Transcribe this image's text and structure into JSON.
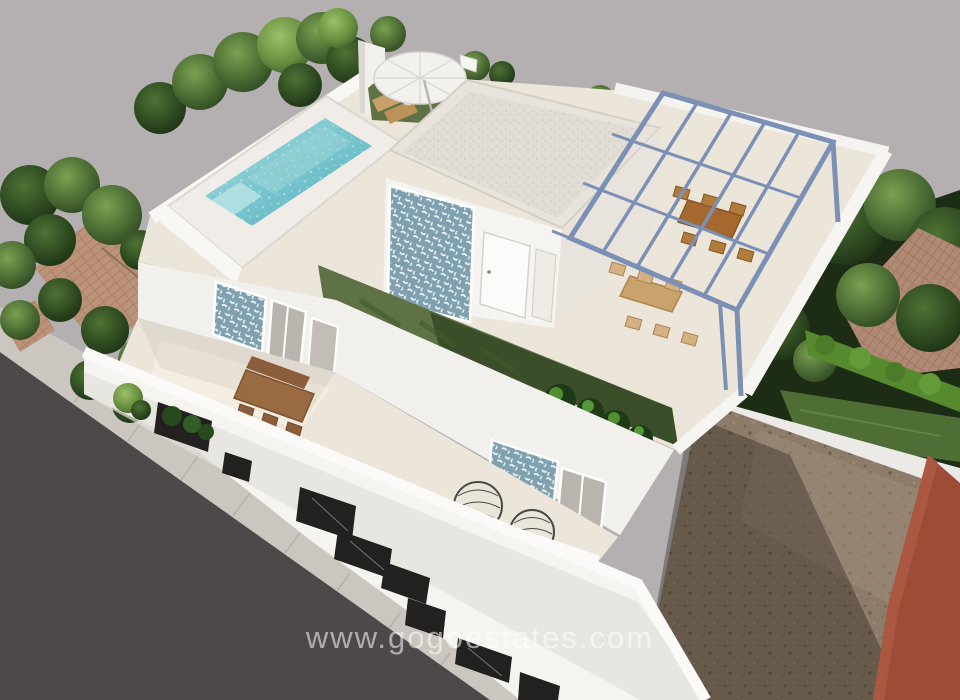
{
  "watermark": {
    "text": "www.gogoestates.com"
  },
  "scene": {
    "kind": "aerial-3d-architectural-render",
    "subject": "modern white villa new-build with rooftop pool and pergola terrace",
    "features": [
      "swimming-pool",
      "pool-deck",
      "parasol-with-sun-loungers",
      "rooftop-penthouse-with-blue-tile-accent",
      "blue-steel-pergola",
      "rooftop-dining-sets",
      "turf-planting-strip-with-tropical-plants",
      "first-floor-terrace-with-wooden-dining-table",
      "egg-chairs",
      "street-facade-with-dark-openings",
      "pavement-and-road",
      "neighbour-terracotta-roofs",
      "right-side-garden-hedge",
      "unbuilt-dirt-plot",
      "terracotta-boundary-building"
    ],
    "palette": {
      "background": "#b4b0b2",
      "road": "#4e4849",
      "sidewalk": "#cbc6bf",
      "villa_white": "#f6f4f1",
      "wall_shade": "#e2dfda",
      "terrace_floor": "#ece5d9",
      "pool_water": "#7cc7cf",
      "turf": "#5f7245",
      "tree_green": "#4a6a33",
      "hedge_green": "#57892f",
      "tile_blue": "#7fa0ae",
      "pergola_blue": "#7b90b4",
      "wood": "#a5763f",
      "terracotta_roof": "#bc9379",
      "red_wall": "#9d4c38",
      "dirt": "#8d7c6a",
      "window_dark": "#23211f"
    }
  }
}
